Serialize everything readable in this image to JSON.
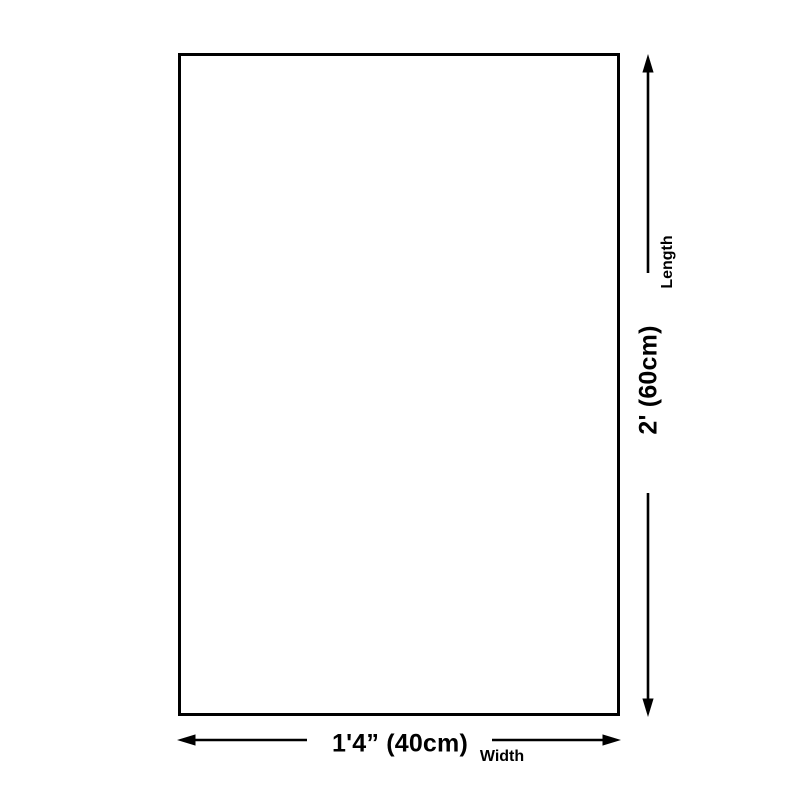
{
  "colors": {
    "background": "#ffffff",
    "line": "#000000",
    "text": "#000000"
  },
  "diagram": {
    "type": "product-dimension-diagram",
    "shape": "rectangle-outline",
    "dimensions": {
      "width": {
        "measurement": "1'4” (40cm)",
        "axis_name": "Width"
      },
      "length": {
        "measurement": "2' (60cm)",
        "axis_name": "Length"
      }
    }
  },
  "icons": {
    "length_arrow": "vertical-double-headed-dimension-arrow",
    "width_arrow": "horizontal-double-headed-dimension-arrow"
  }
}
